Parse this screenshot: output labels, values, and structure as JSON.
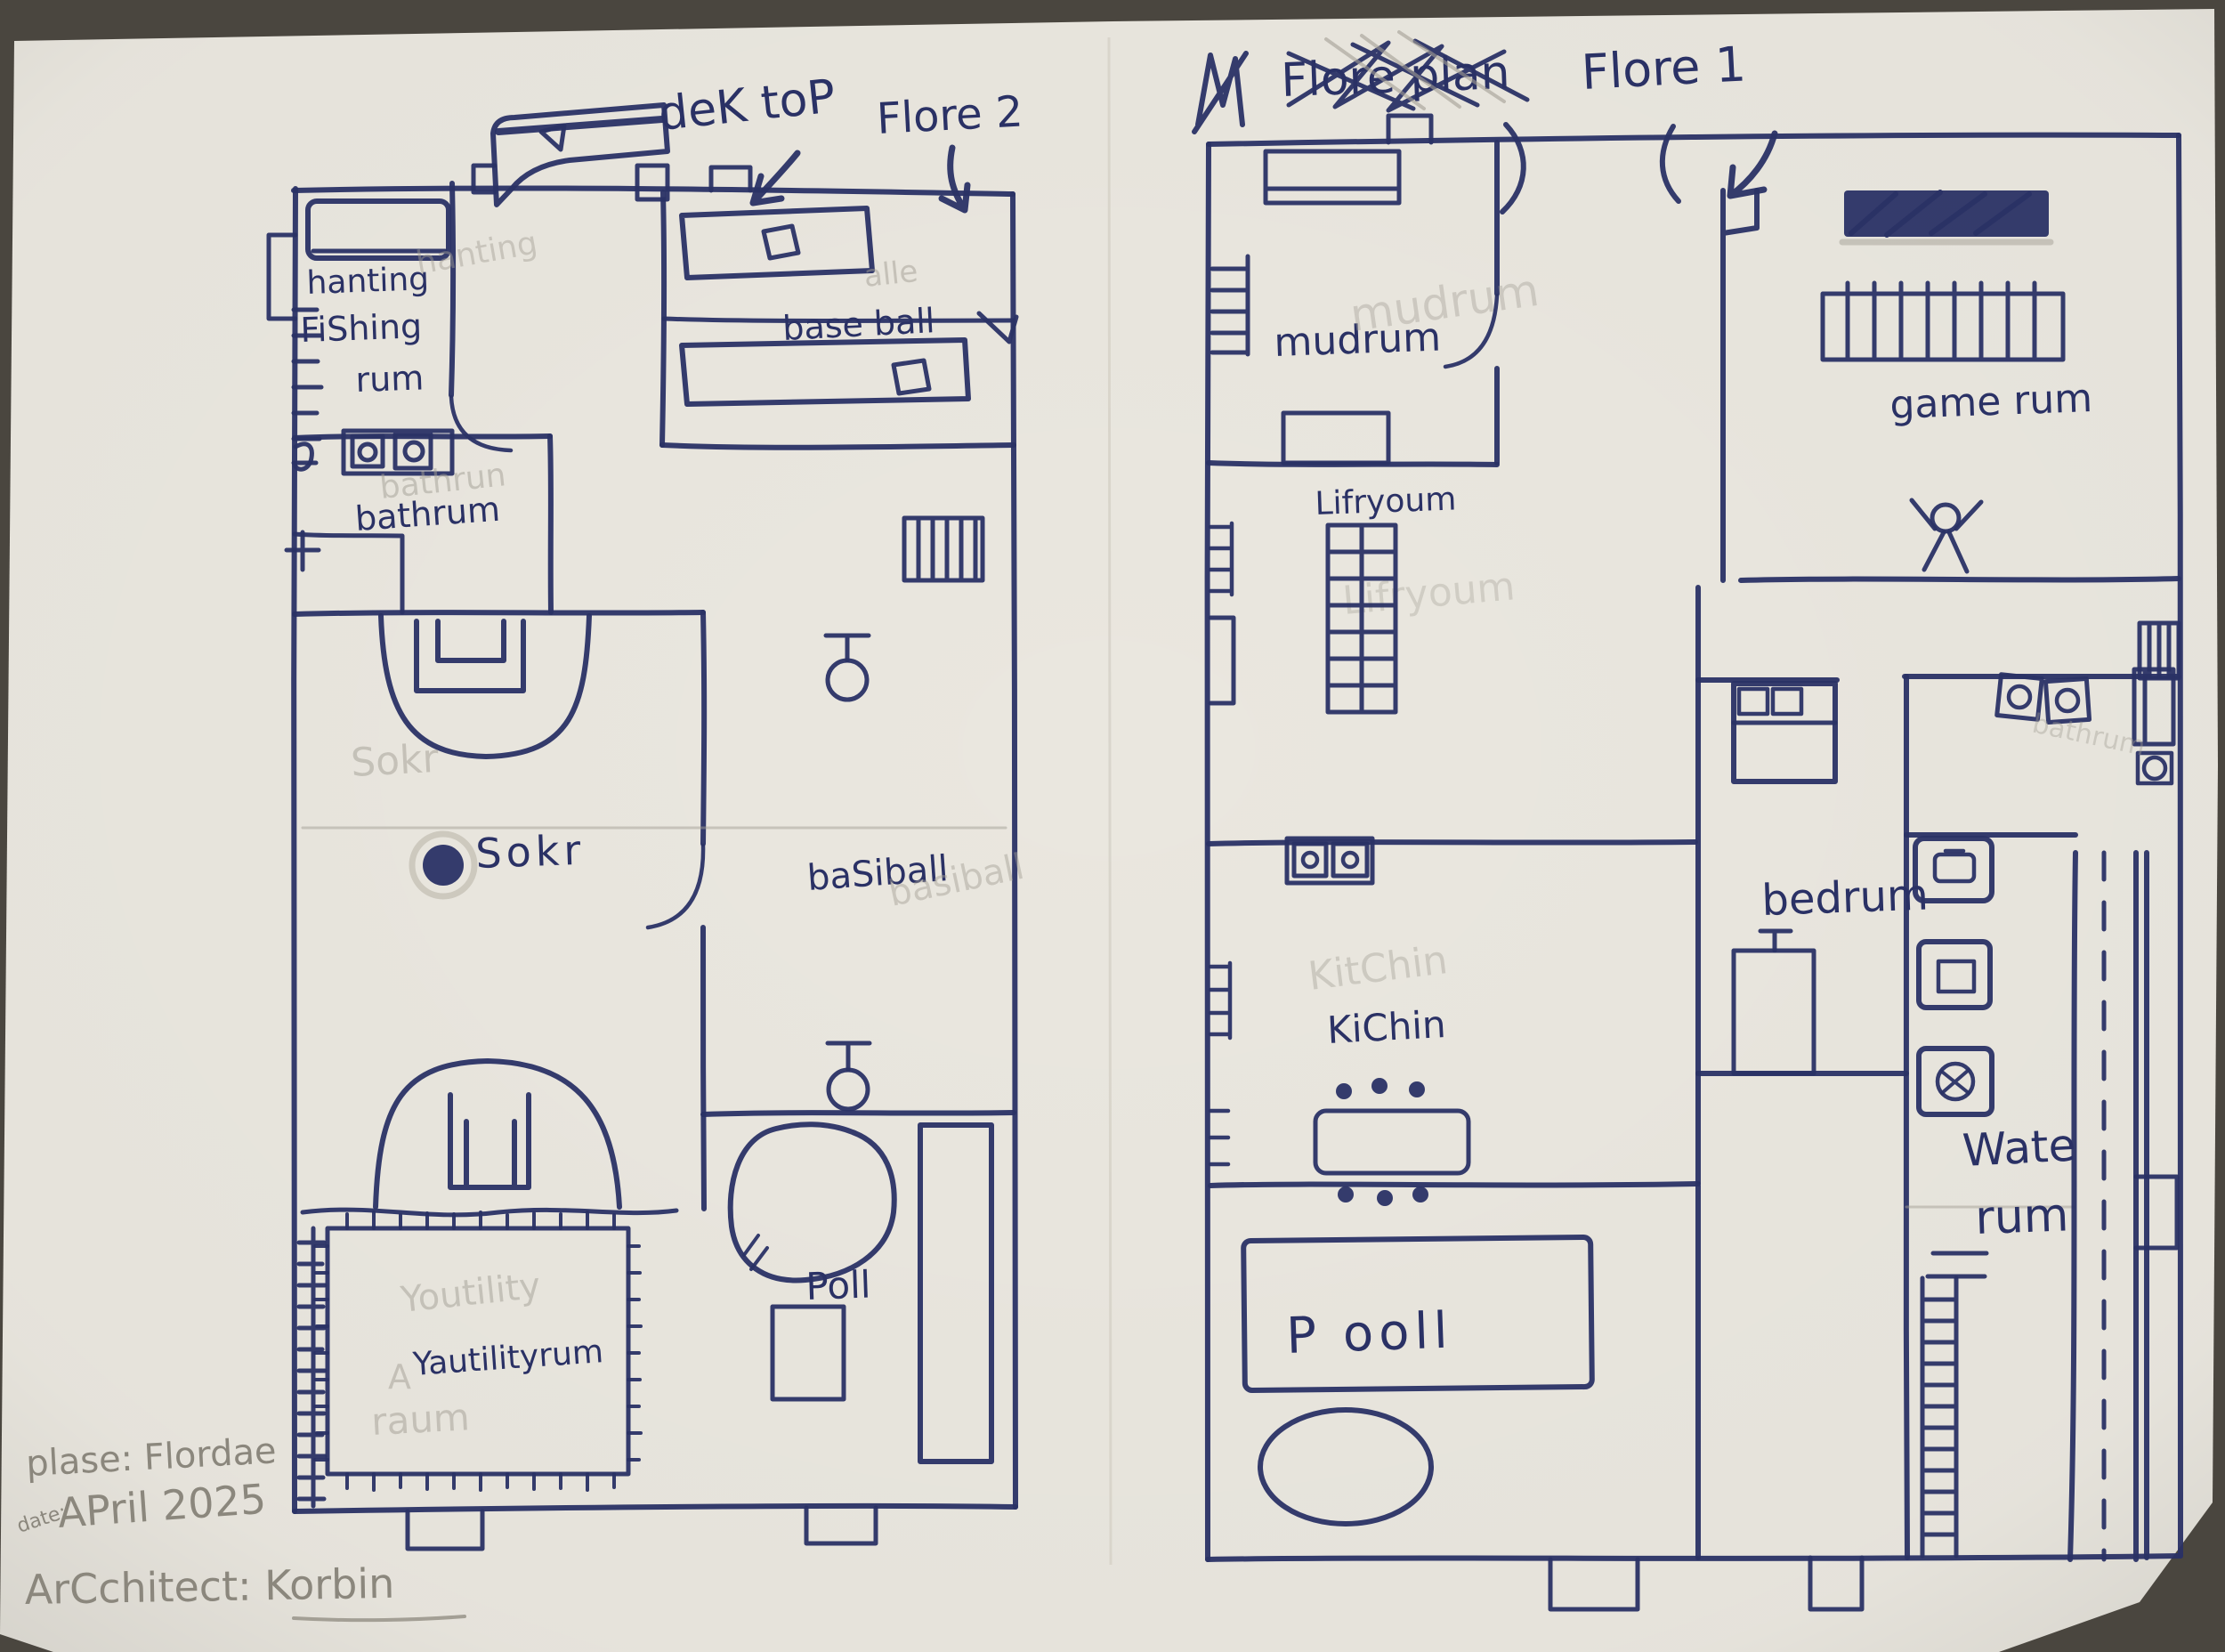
{
  "photo": {
    "table_color": "#4a463f",
    "paper_color": "#eae7df",
    "ink_color": "#2a3165",
    "pencil_color": "#a39f95",
    "footer_pencil_color": "#8b877d"
  },
  "floor2": {
    "desk_label": "deK toP",
    "title": "Flore 2",
    "rooms": {
      "hunting_fishing_line1": "hanting",
      "hunting_fishing_line2": "FiShing",
      "hunting_fishing_line3": "rum",
      "baseball": "base ball",
      "bathroom": "bathrum",
      "soccer": "Sokr",
      "basketball": "baSiball",
      "pool": "Poll",
      "utility": "Yautilityrum"
    },
    "pencil_ghosts": {
      "hunting": "hanting",
      "baseball": "alle",
      "bathroom": "bathrun",
      "soccer": "Sokr",
      "basketball": "basiball",
      "utility_top": "Youtility",
      "utility_bottom": "raum",
      "utility_mark": "A"
    }
  },
  "floor1": {
    "crossed_out_title": "Flore plan",
    "title": "Flore 1",
    "rooms": {
      "mudroom": "mudrum",
      "living_room": "Lifryoum",
      "kitchen": "KiChin",
      "pool": "P ooll",
      "game_room": "game rum",
      "bedroom": "bedrum",
      "water_line1": "Wate",
      "water_line2": "rum"
    },
    "pencil_ghosts": {
      "mudroom": "mudrum",
      "living_room": "Lifryoum",
      "kitchen": "KitChin",
      "bathroom": "bathrum"
    }
  },
  "footer": {
    "place_line": "plase: Flordae",
    "date_prefix": "date:",
    "date_line": "APril 2025",
    "architect_line": "ArCchitect: Korbin"
  }
}
